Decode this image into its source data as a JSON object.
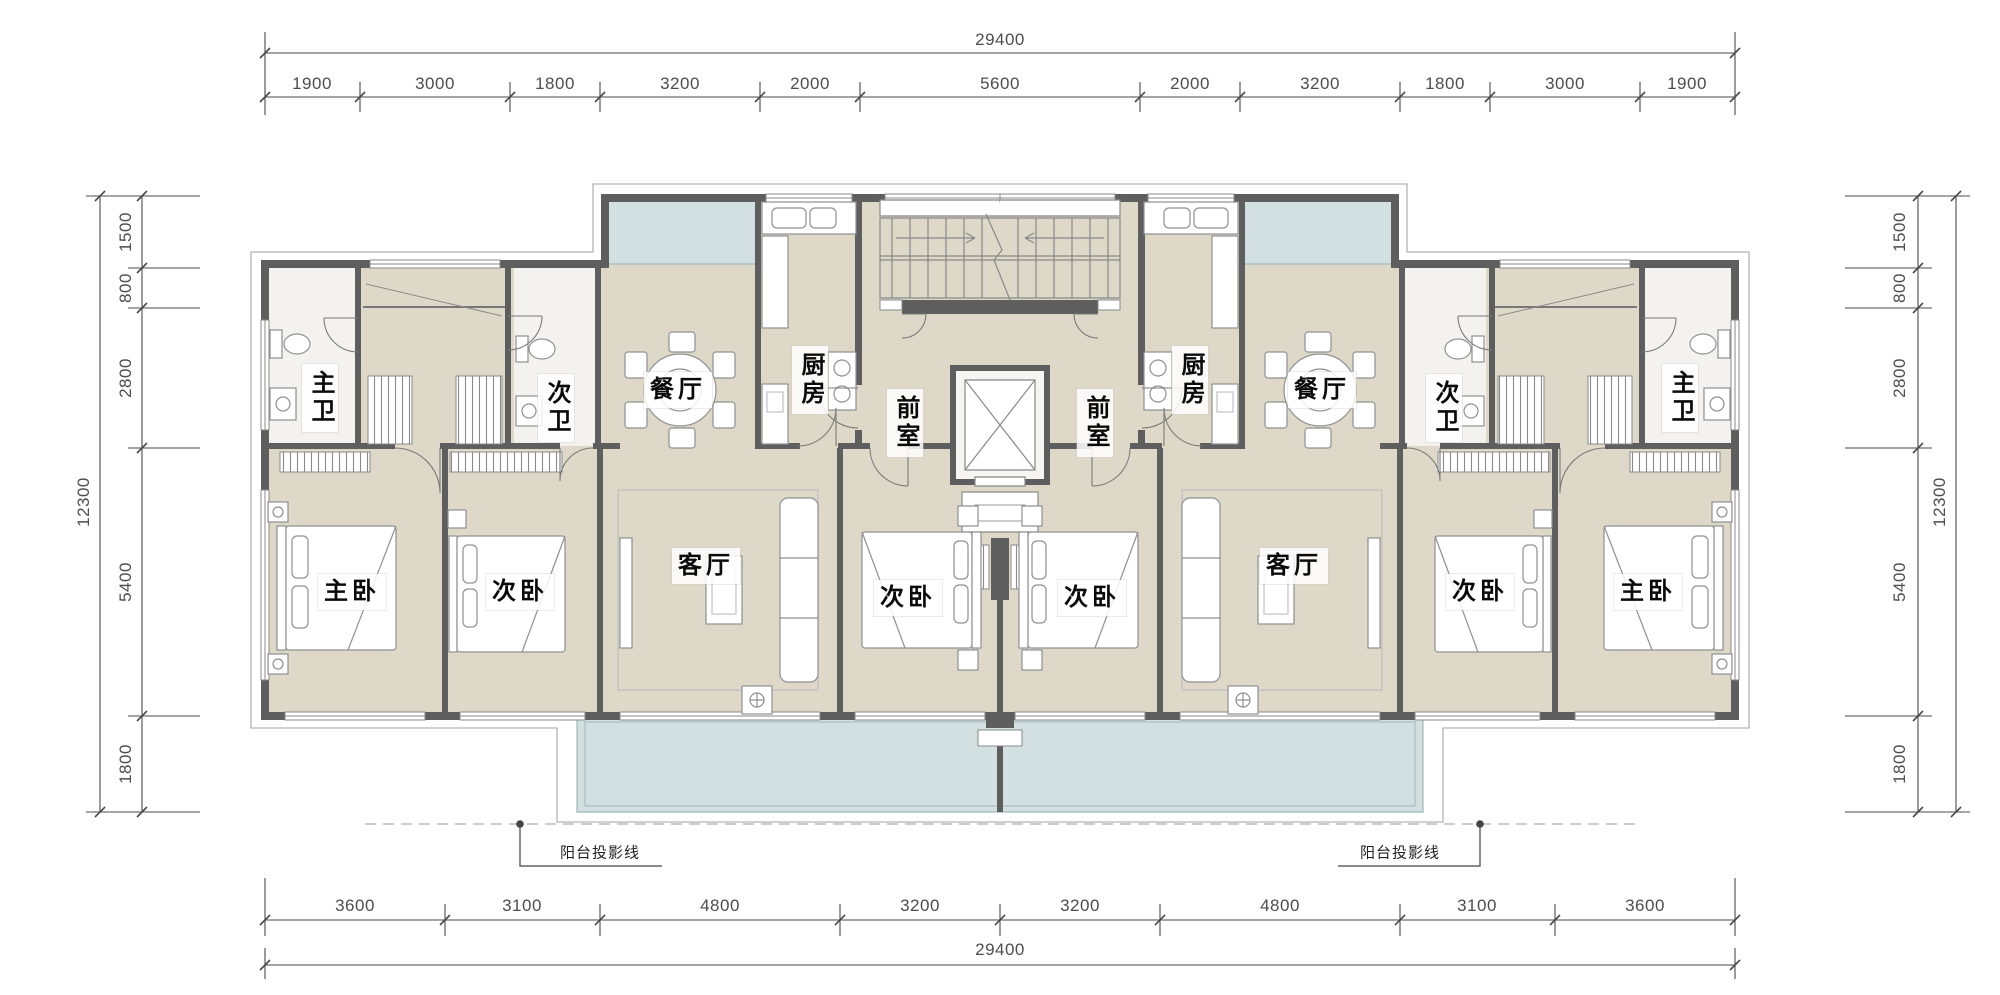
{
  "drawing": {
    "type": "residential-floor-plan",
    "language": "zh-CN",
    "colors": {
      "wall": "#5e5e5e",
      "floor": "#ddd8c8",
      "balcony": "#d2e0e1",
      "dim_text": "#4d4d4d",
      "label_text": "#0a0a0a",
      "label_background": "#ffffff"
    }
  },
  "dimensions": {
    "top": {
      "total": "29400",
      "segments": [
        "1900",
        "3000",
        "1800",
        "3200",
        "2000",
        "5600",
        "2000",
        "3200",
        "1800",
        "3000",
        "1900"
      ]
    },
    "bottom": {
      "total": "29400",
      "segments": [
        "3600",
        "3100",
        "4800",
        "3200",
        "3200",
        "4800",
        "3100",
        "3600"
      ]
    },
    "left": {
      "total": "12300",
      "segments": [
        "1500",
        "800",
        "2800",
        "5400",
        "1800"
      ]
    },
    "right": {
      "total": "12300",
      "segments": [
        "1500",
        "800",
        "2800",
        "5400",
        "1800"
      ]
    }
  },
  "rooms": {
    "kitchen_left": "厨房",
    "kitchen_right": "厨房",
    "dining_left": "餐厅",
    "dining_right": "餐厅",
    "lobby_left": "前室",
    "lobby_right": "前室",
    "master_bath_left": "主卫",
    "master_bath_right": "主卫",
    "second_bath_left": "次卫",
    "second_bath_right": "次卫",
    "master_bed_left": "主卧",
    "master_bed_right": "主卧",
    "second_bed_left": "次卧",
    "second_bed_center_left": "次卧",
    "second_bed_center_right": "次卧",
    "second_bed_right": "次卧",
    "living_left": "客厅",
    "living_right": "客厅"
  },
  "annotations": {
    "balcony_projection_left": "阳台投影线",
    "balcony_projection_right": "阳台投影线"
  }
}
